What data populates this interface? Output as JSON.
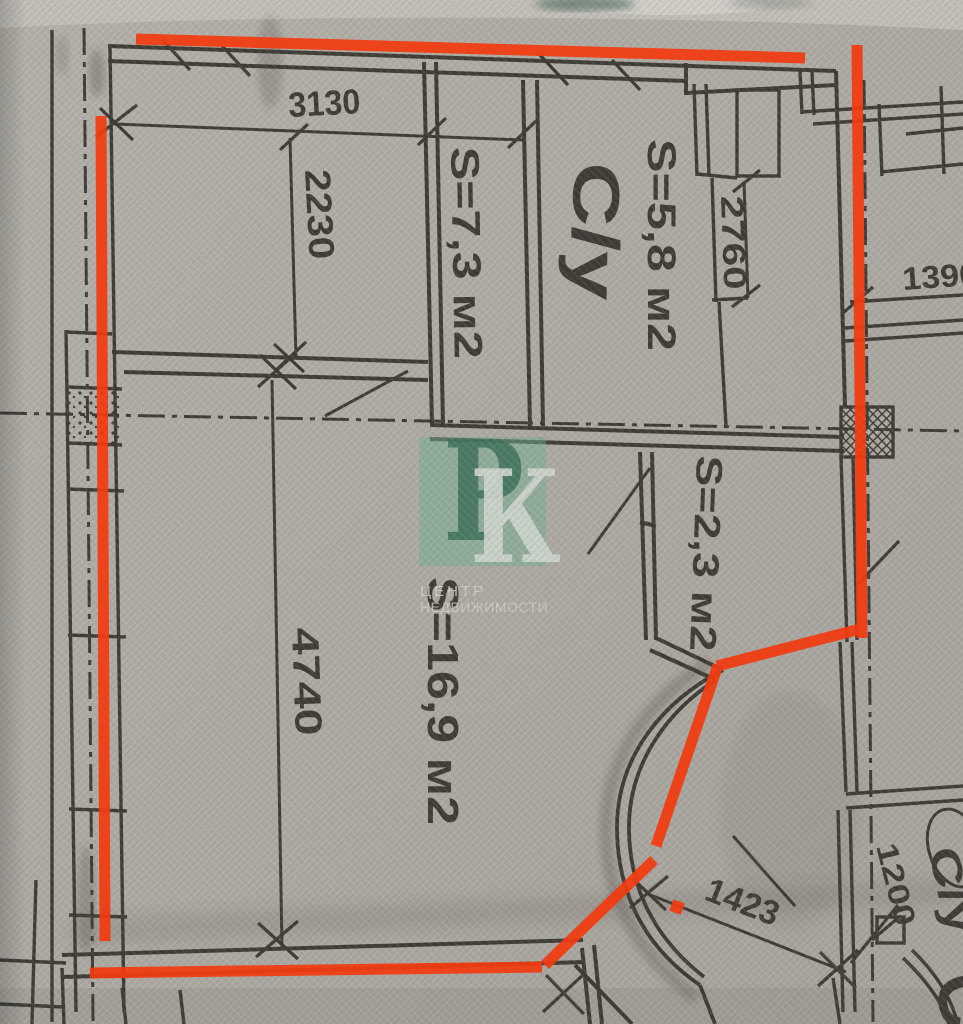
{
  "labels": {
    "dim_3130": "3130",
    "dim_2230": "2230",
    "room_73": "S=7,3 м2",
    "bathroom": "С/у",
    "room_58": "S=5,8 м2",
    "dim_2760": "2760",
    "dim_1390": "1390",
    "room_23": "S=2,3 м2",
    "room_169": "S=16,9 м2",
    "dim_4740": "4740",
    "dim_1423": "1423",
    "dim_1200": "1200",
    "neighbor_bathroom": "С/у",
    "corner_letter": "С"
  },
  "watermark": {
    "letter1": "Р",
    "letter2": "К",
    "caption_line1": "ЦЕНТР",
    "caption_line2": "НЕДВИЖИМОСТИ"
  },
  "colors": {
    "annotation_red": "#f23b10",
    "ink": "#2a2722",
    "paper": "#bcb9b4",
    "watermark_green": "#6fbe97",
    "watermark_letter_dark": "#256b4f",
    "watermark_letter_light": "#e7f2ea"
  }
}
